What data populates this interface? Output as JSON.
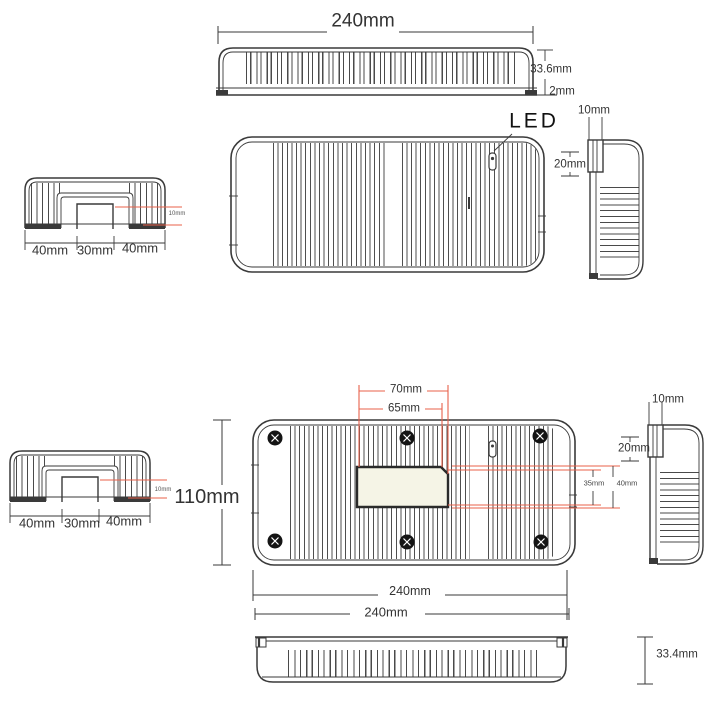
{
  "colors": {
    "line": "#3a3a3a",
    "accent_red": "#e8604a",
    "cutout_fill": "#f5f4e6"
  },
  "front_view": {
    "width": "240mm",
    "height": "33.6mm",
    "base_thickness": "2mm"
  },
  "plan_view": {
    "led": "LED"
  },
  "end_view_upper": {
    "tab_width": "10mm",
    "tab_depth": "20mm"
  },
  "profile_upper": {
    "seg_left": "40mm",
    "seg_center": "30mm",
    "seg_right": "40mm",
    "foot": "10mm"
  },
  "profile_lower": {
    "seg_left": "40mm",
    "seg_center": "30mm",
    "seg_right": "40mm",
    "foot": "10mm"
  },
  "base_plan_view": {
    "cutout_width_outer": "70mm",
    "cutout_width_inner": "65mm",
    "cutout_height_inner": "35mm",
    "cutout_height_outer": "40mm",
    "body_height": "110mm",
    "width": "240mm",
    "width_overall": "240mm"
  },
  "end_view_lower": {
    "tab_width": "10mm",
    "tab_depth": "20mm"
  },
  "bottom_view": {
    "height": "33.4mm"
  }
}
